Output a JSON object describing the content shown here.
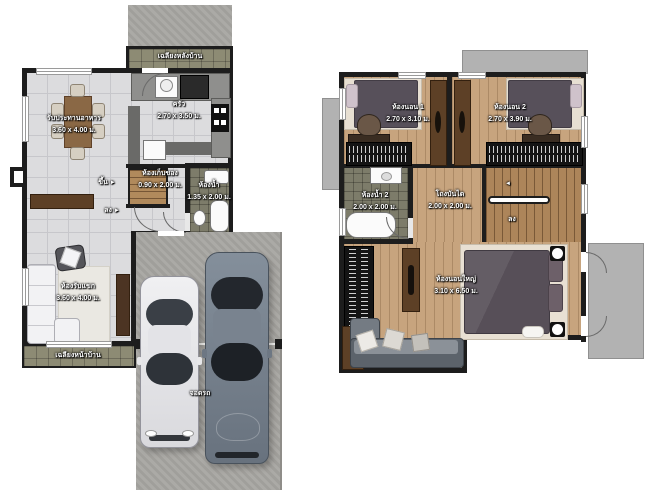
{
  "floor1": {
    "back_porch": {
      "label": "เฉลียงหลังบ้าน"
    },
    "dining": {
      "label": "รับประทานอาหาร",
      "dims": "3.60 x 4.00 ม."
    },
    "kitchen": {
      "label": "ครัว",
      "dims": "2.70 x 3.50 ม."
    },
    "storage": {
      "label": "ห้องเก็บของ",
      "dims": "0.90 x 2.00 ม."
    },
    "bathroom": {
      "label": "ห้องน้ำ",
      "dims": "1.35 x 2.00 ม."
    },
    "stairs_up": {
      "label": "ขึ้น",
      "arrow": "►"
    },
    "stairs_down": {
      "label": "ลง",
      "arrow": "►"
    },
    "living": {
      "label": "ห้องรับแขก",
      "dims": "3.60 x 4.00 ม."
    },
    "front_porch": {
      "label": "เฉลียงหน้าบ้าน"
    },
    "parking": {
      "label": "จอดรถ"
    }
  },
  "floor2": {
    "bedroom1": {
      "label": "ห้องนอน 1",
      "dims": "2.70 x 3.10 ม."
    },
    "bedroom2": {
      "label": "ห้องนอน 2",
      "dims": "2.70 x 3.90 ม."
    },
    "bathroom2": {
      "label": "ห้องน้ำ 2",
      "dims": "2.00 x 2.00 ม."
    },
    "stair_hall": {
      "label": "โถงบันได",
      "dims": "2.00 x 2.00 ม."
    },
    "stairs_down": {
      "label": "ลง",
      "arrow": "◄"
    },
    "master_bedroom": {
      "label": "ห้องนอนใหญ่",
      "dims": "3.10 x 6.50 ม."
    }
  },
  "colors": {
    "wall": "#1d1d1d",
    "tile_floor": "#dcdcde",
    "porch_tile": "#8d8b74",
    "bath_tile": "#7d7c6a",
    "wood_floor": "#c7a47e",
    "concrete": "#a7a5a1",
    "roof_gray": "#b2b2b2",
    "bed_blanket": "#57505a",
    "sofa_gray": "#747b83"
  }
}
